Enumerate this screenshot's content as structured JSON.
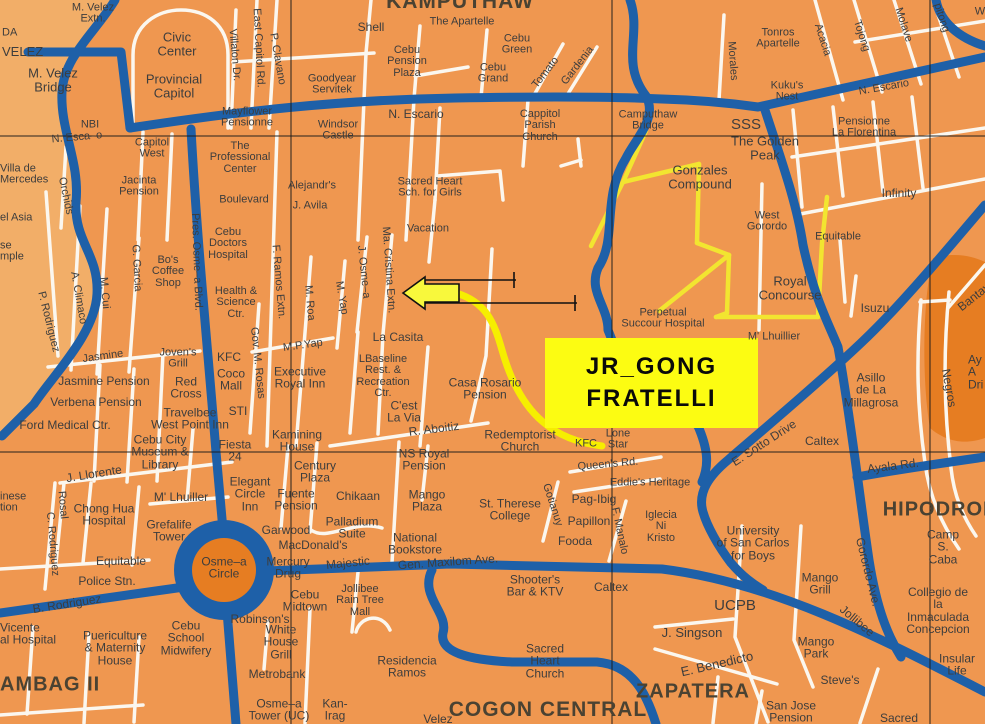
{
  "colors": {
    "base": "#EF9750",
    "light": "#F2AE68",
    "dark": "#E67D22",
    "road_blue": "#1E60A8",
    "road_white": "#FBF7EF",
    "road_yellow": "#F2E530",
    "route_yellow": "#F6EE00",
    "box_yellow": "#FCFC12",
    "ink": "#3D3D3D",
    "grid": "#1B1B1B"
  },
  "map": {
    "highlight": {
      "line1": "JR_GONG",
      "line2": "FRATELLI"
    },
    "labels": [
      {
        "t": "M. Velez\nExtn.",
        "x": 93,
        "y": 14
      },
      {
        "t": "DA",
        "x": 2,
        "y": 33,
        "a": "l"
      },
      {
        "t": "VELEZ",
        "x": 2,
        "y": 52,
        "s": 13,
        "a": "l"
      },
      {
        "t": "Civic\nCenter",
        "x": 177,
        "y": 44,
        "s": 13
      },
      {
        "t": "Shell",
        "x": 371,
        "y": 27,
        "s": 12
      },
      {
        "t": "The Apartelle",
        "x": 462,
        "y": 22
      },
      {
        "t": "KAMPUTHAW",
        "x": 460,
        "y": 2,
        "s": 21,
        "b": 1
      },
      {
        "t": "Cebu\nPension\nPlaza",
        "x": 407,
        "y": 62
      },
      {
        "t": "Cebu\nGreen",
        "x": 517,
        "y": 45
      },
      {
        "t": "Cebu\nGrand",
        "x": 493,
        "y": 74
      },
      {
        "t": "Tomato",
        "x": 546,
        "y": 73,
        "r": -52
      },
      {
        "t": "Gardenia",
        "x": 578,
        "y": 66,
        "r": -52
      },
      {
        "t": "Tonros\nApartelle",
        "x": 778,
        "y": 39
      },
      {
        "t": "Morales",
        "x": 732,
        "y": 61,
        "r": 86
      },
      {
        "t": "Acacia",
        "x": 822,
        "y": 40,
        "r": 72
      },
      {
        "t": "Tojong",
        "x": 861,
        "y": 36,
        "r": 72
      },
      {
        "t": "Molave",
        "x": 903,
        "y": 25,
        "r": 72
      },
      {
        "t": "pitong",
        "x": 941,
        "y": 18,
        "r": 72
      },
      {
        "t": "W",
        "x": 980,
        "y": 12
      },
      {
        "t": "M. Velez\nBridge",
        "x": 53,
        "y": 80,
        "s": 13
      },
      {
        "t": "Provincial\nCapitol",
        "x": 174,
        "y": 86,
        "s": 13
      },
      {
        "t": "Goodyear\nServitek",
        "x": 332,
        "y": 85
      },
      {
        "t": "N. Escario",
        "x": 416,
        "y": 114,
        "s": 12
      },
      {
        "t": "Cappitol\nParish\nChurch",
        "x": 540,
        "y": 126
      },
      {
        "t": "Camputhaw\nBridge",
        "x": 648,
        "y": 121
      },
      {
        "t": "SSS",
        "x": 746,
        "y": 125,
        "s": 15
      },
      {
        "t": "Kuku's\nNest",
        "x": 787,
        "y": 92
      },
      {
        "t": "N. Escario",
        "x": 884,
        "y": 88,
        "r": -10
      },
      {
        "t": "The Golden\nPeak",
        "x": 765,
        "y": 148,
        "s": 13
      },
      {
        "t": "Pensionne\nLa Florentina",
        "x": 864,
        "y": 128
      },
      {
        "t": "NBI",
        "x": 90,
        "y": 125
      },
      {
        "t": "N. Esca–o",
        "x": 77,
        "y": 138,
        "r": -5
      },
      {
        "t": "Mayflower\nPensionne",
        "x": 247,
        "y": 118
      },
      {
        "t": "Windsor\nCastle",
        "x": 338,
        "y": 131
      },
      {
        "t": "The\nProfessional\nCenter",
        "x": 240,
        "y": 158
      },
      {
        "t": "Capitol\nWest",
        "x": 152,
        "y": 149
      },
      {
        "t": "Villalon Dr.",
        "x": 234,
        "y": 55,
        "r": 85
      },
      {
        "t": "East Capitol Rd.",
        "x": 258,
        "y": 48,
        "r": 87
      },
      {
        "t": "P. Clavano",
        "x": 277,
        "y": 59,
        "r": 80
      },
      {
        "t": "Villa de\nMercedes",
        "x": 0,
        "y": 175,
        "a": "l"
      },
      {
        "t": "Orchids",
        "x": 65,
        "y": 196,
        "r": 78
      },
      {
        "t": "Jacinta\nPension",
        "x": 139,
        "y": 187
      },
      {
        "t": "Boulevard",
        "x": 244,
        "y": 200
      },
      {
        "t": "Alejandr's",
        "x": 312,
        "y": 186
      },
      {
        "t": "J. Avila",
        "x": 310,
        "y": 206
      },
      {
        "t": "el Asia",
        "x": 0,
        "y": 218,
        "a": "l"
      },
      {
        "t": "Gonzales\nCompound",
        "x": 700,
        "y": 177,
        "s": 13
      },
      {
        "t": "Infinity",
        "x": 899,
        "y": 193,
        "s": 12
      },
      {
        "t": "West\nGorordo",
        "x": 767,
        "y": 222
      },
      {
        "t": "Equitable",
        "x": 838,
        "y": 237
      },
      {
        "t": "Sacred Heart\nSch. for Girls",
        "x": 430,
        "y": 188
      },
      {
        "t": "Vacation",
        "x": 428,
        "y": 229
      },
      {
        "t": "se\nmple",
        "x": 0,
        "y": 252,
        "a": "l"
      },
      {
        "t": "Cebu\nDoctors\nHospital",
        "x": 228,
        "y": 244
      },
      {
        "t": "F. Ramos Extn.",
        "x": 278,
        "y": 282,
        "r": 85
      },
      {
        "t": "M. Roa",
        "x": 309,
        "y": 303,
        "r": 85
      },
      {
        "t": "P. Rodriguez",
        "x": 48,
        "y": 322,
        "r": 76
      },
      {
        "t": "A. Climaco",
        "x": 78,
        "y": 298,
        "r": 80
      },
      {
        "t": "M. Cui",
        "x": 104,
        "y": 293,
        "r": 85
      },
      {
        "t": "G. Garcia",
        "x": 136,
        "y": 268,
        "r": 87
      },
      {
        "t": "Bo's\nCoffee\nShop",
        "x": 168,
        "y": 272
      },
      {
        "t": "Pres. Osme–a Blvd.",
        "x": 196,
        "y": 262,
        "r": 88
      },
      {
        "t": "Health &\nScience\nCtr.",
        "x": 236,
        "y": 303
      },
      {
        "t": "Gov. M. Rosas",
        "x": 257,
        "y": 363,
        "r": 84
      },
      {
        "t": "M.P.Yap",
        "x": 303,
        "y": 346,
        "r": -8
      },
      {
        "t": "M. Yap",
        "x": 341,
        "y": 298,
        "r": 80
      },
      {
        "t": "J. Osme–a",
        "x": 363,
        "y": 272,
        "r": 84
      },
      {
        "t": "Ma. Cristina Extn.",
        "x": 388,
        "y": 270,
        "r": 86
      },
      {
        "t": "Jasmine",
        "x": 103,
        "y": 357,
        "r": -8
      },
      {
        "t": "Joven's\nGrill",
        "x": 178,
        "y": 359
      },
      {
        "t": "KFC",
        "x": 229,
        "y": 357,
        "s": 12
      },
      {
        "t": "Coco\nMall",
        "x": 231,
        "y": 380,
        "s": 12
      },
      {
        "t": "Executive\nRoyal Inn",
        "x": 300,
        "y": 378,
        "s": 12
      },
      {
        "t": "Jasmine Pension",
        "x": 104,
        "y": 381,
        "s": 12
      },
      {
        "t": "Red\nCross",
        "x": 186,
        "y": 388,
        "s": 12
      },
      {
        "t": "Verbena Pension",
        "x": 96,
        "y": 402,
        "s": 12
      },
      {
        "t": "Travelbee\nWest Point Inn",
        "x": 190,
        "y": 419,
        "s": 12
      },
      {
        "t": "STI",
        "x": 238,
        "y": 411,
        "s": 12
      },
      {
        "t": "Ford Medical Ctr.",
        "x": 65,
        "y": 425,
        "s": 12
      },
      {
        "t": "Cebu City\nMuseum &\nLibrary",
        "x": 160,
        "y": 452,
        "s": 12
      },
      {
        "t": "Fiesta\n24",
        "x": 235,
        "y": 451,
        "s": 12
      },
      {
        "t": "Kamining\nHouse",
        "x": 297,
        "y": 441,
        "s": 12
      },
      {
        "t": "J. Llorente",
        "x": 94,
        "y": 474,
        "r": -9,
        "s": 12
      },
      {
        "t": "La Casita",
        "x": 398,
        "y": 337,
        "s": 12
      },
      {
        "t": "LBaseline\nRest. &\nRecreation\nCtr.",
        "x": 383,
        "y": 377,
        "s": 11
      },
      {
        "t": "Casa Rosario\nPension",
        "x": 485,
        "y": 389,
        "s": 12
      },
      {
        "t": "C'est\nLa Via",
        "x": 404,
        "y": 412,
        "s": 12
      },
      {
        "t": "R. Aboitiz",
        "x": 434,
        "y": 429,
        "r": -7,
        "s": 12
      },
      {
        "t": "NS Royal\nPension",
        "x": 424,
        "y": 460,
        "s": 12
      },
      {
        "t": "Redemptorist\nChurch",
        "x": 520,
        "y": 441,
        "s": 12
      },
      {
        "t": "KFC",
        "x": 586,
        "y": 444
      },
      {
        "t": "Lone\nStar",
        "x": 618,
        "y": 440
      },
      {
        "t": "Queen's Rd.",
        "x": 608,
        "y": 465,
        "r": -5
      },
      {
        "t": "Eddie's Heritage",
        "x": 650,
        "y": 483
      },
      {
        "t": "Perpetual\nSuccour Hospital",
        "x": 663,
        "y": 319
      },
      {
        "t": "M' Lhuillier",
        "x": 774,
        "y": 337
      },
      {
        "t": "Royal\nConcourse",
        "x": 790,
        "y": 288,
        "s": 13
      },
      {
        "t": "Isuzu",
        "x": 875,
        "y": 308,
        "s": 12
      },
      {
        "t": "Asillo\nde La\nMillagrosa",
        "x": 871,
        "y": 390,
        "s": 12
      },
      {
        "t": "Negros",
        "x": 949,
        "y": 388,
        "r": 80,
        "s": 12
      },
      {
        "t": "Bantay",
        "x": 974,
        "y": 297,
        "r": -38,
        "s": 12
      },
      {
        "t": "Ay\nA\nDri",
        "x": 968,
        "y": 372,
        "s": 12,
        "a": "l"
      },
      {
        "t": "E. Sotto Drive",
        "x": 764,
        "y": 443,
        "r": -33,
        "s": 12
      },
      {
        "t": "Caltex",
        "x": 822,
        "y": 441,
        "s": 12
      },
      {
        "t": "Ayala Rd.",
        "x": 893,
        "y": 466,
        "r": -7,
        "s": 12
      },
      {
        "t": "Gorordo Ave.",
        "x": 868,
        "y": 572,
        "r": 76,
        "s": 12
      },
      {
        "t": "Jollibee",
        "x": 857,
        "y": 621,
        "r": 40,
        "s": 12
      },
      {
        "t": "HIPODROMO",
        "x": 950,
        "y": 510,
        "b": 1
      },
      {
        "t": "Camp S. Caba",
        "x": 943,
        "y": 547,
        "s": 12
      },
      {
        "t": "Collegio de la\nInmaculada\nConcepcion",
        "x": 938,
        "y": 611,
        "s": 12
      },
      {
        "t": "Insular Life",
        "x": 957,
        "y": 665,
        "s": 12
      },
      {
        "t": "University\nof San Carlos\nfor Boys",
        "x": 753,
        "y": 543,
        "s": 12
      },
      {
        "t": "Mango\nGrill",
        "x": 820,
        "y": 584,
        "s": 12
      },
      {
        "t": "UCPB",
        "x": 735,
        "y": 606,
        "s": 15
      },
      {
        "t": "J. Singson",
        "x": 692,
        "y": 633,
        "s": 13
      },
      {
        "t": "E. Benedicto",
        "x": 717,
        "y": 664,
        "r": -13,
        "s": 13
      },
      {
        "t": "Mango\nPark",
        "x": 816,
        "y": 648,
        "s": 12
      },
      {
        "t": "Steve's",
        "x": 840,
        "y": 680,
        "s": 12
      },
      {
        "t": "San Jose\nPension",
        "x": 791,
        "y": 712,
        "s": 12
      },
      {
        "t": "Sacred",
        "x": 899,
        "y": 718,
        "s": 12
      },
      {
        "t": "ZAPATERA",
        "x": 693,
        "y": 692,
        "b": 1
      },
      {
        "t": "Iglecia\nNi\nKristo",
        "x": 661,
        "y": 527
      },
      {
        "t": "F. Manalo",
        "x": 619,
        "y": 531,
        "r": 78
      },
      {
        "t": "Gotianuy",
        "x": 552,
        "y": 505,
        "r": 72
      },
      {
        "t": "Pag-Ibig",
        "x": 594,
        "y": 499,
        "s": 12
      },
      {
        "t": "Papillon",
        "x": 589,
        "y": 521,
        "s": 12
      },
      {
        "t": "Fooda",
        "x": 575,
        "y": 541,
        "s": 12
      },
      {
        "t": "Caltex",
        "x": 611,
        "y": 587,
        "s": 12
      },
      {
        "t": "Shooter's\nBar & KTV",
        "x": 535,
        "y": 586,
        "s": 12
      },
      {
        "t": "St. Therese\nCollege",
        "x": 510,
        "y": 510,
        "s": 12
      },
      {
        "t": "Mango\nPlaza",
        "x": 427,
        "y": 501,
        "s": 12
      },
      {
        "t": "Chikaan",
        "x": 358,
        "y": 496,
        "s": 12
      },
      {
        "t": "Palladium\nSuite",
        "x": 352,
        "y": 528,
        "s": 12
      },
      {
        "t": "National\nBookstore",
        "x": 415,
        "y": 544,
        "s": 12
      },
      {
        "t": "Majestic",
        "x": 348,
        "y": 563,
        "r": -6,
        "s": 12
      },
      {
        "t": "Mercury\nDrug",
        "x": 288,
        "y": 568,
        "s": 12
      },
      {
        "t": "MacDonald's",
        "x": 313,
        "y": 545,
        "s": 12
      },
      {
        "t": "Garwood",
        "x": 286,
        "y": 530,
        "s": 12
      },
      {
        "t": "Century\nPlaza",
        "x": 315,
        "y": 472,
        "s": 12
      },
      {
        "t": "Elegant\nCircle\nInn",
        "x": 250,
        "y": 494,
        "s": 12
      },
      {
        "t": "Fuente\nPension",
        "x": 296,
        "y": 500,
        "s": 12
      },
      {
        "t": "M' Lhuiller",
        "x": 181,
        "y": 497,
        "s": 12
      },
      {
        "t": "Grefalife\nTower",
        "x": 169,
        "y": 531,
        "s": 12
      },
      {
        "t": "Chong Hua\nHospital",
        "x": 104,
        "y": 515,
        "s": 12
      },
      {
        "t": "Equitable",
        "x": 121,
        "y": 561,
        "s": 12
      },
      {
        "t": "Police Stn.",
        "x": 107,
        "y": 581,
        "s": 12
      },
      {
        "t": "Rosal",
        "x": 62,
        "y": 505,
        "r": 85
      },
      {
        "t": "C. Rodriguez",
        "x": 52,
        "y": 544,
        "r": 85
      },
      {
        "t": "inese\ntion",
        "x": 0,
        "y": 503,
        "a": "l"
      },
      {
        "t": "B. Rodriguez",
        "x": 67,
        "y": 604,
        "r": -9,
        "s": 12
      },
      {
        "t": "Osme–a\nCircle",
        "x": 224,
        "y": 568,
        "s": 12
      },
      {
        "t": "Vicente\nal Hospital",
        "x": 0,
        "y": 634,
        "a": "l",
        "s": 12
      },
      {
        "t": "Puericulture\n& Maternity\nHouse",
        "x": 115,
        "y": 648,
        "s": 12
      },
      {
        "t": "Cebu\nSchool\nMidwifery",
        "x": 186,
        "y": 638,
        "s": 12
      },
      {
        "t": "AMBAG II",
        "x": 0,
        "y": 685,
        "b": 1,
        "a": "l"
      },
      {
        "t": "Robinson's",
        "x": 260,
        "y": 619,
        "s": 12
      },
      {
        "t": "Cebu\nMidtown",
        "x": 305,
        "y": 601,
        "s": 12
      },
      {
        "t": "White\nHouse\nGrill",
        "x": 281,
        "y": 642,
        "s": 12
      },
      {
        "t": "Metrobank",
        "x": 277,
        "y": 674,
        "s": 12
      },
      {
        "t": "Osme–a\nTower (UC)",
        "x": 279,
        "y": 710,
        "s": 12
      },
      {
        "t": "Jollibee\nRain Tree\nMall",
        "x": 360,
        "y": 601
      },
      {
        "t": "Residencia\nRamos",
        "x": 407,
        "y": 667,
        "s": 12
      },
      {
        "t": "Kan-\nIrag",
        "x": 335,
        "y": 710,
        "s": 12
      },
      {
        "t": "Velez",
        "x": 438,
        "y": 719,
        "s": 12
      },
      {
        "t": "COGON CENTRAL",
        "x": 548,
        "y": 710,
        "b": 1,
        "s": 21
      },
      {
        "t": "Sacred\nHeart\nChurch",
        "x": 545,
        "y": 661,
        "s": 12
      },
      {
        "t": "Gen. Maxilom Ave.",
        "x": 448,
        "y": 562,
        "r": -4,
        "s": 12
      }
    ]
  }
}
